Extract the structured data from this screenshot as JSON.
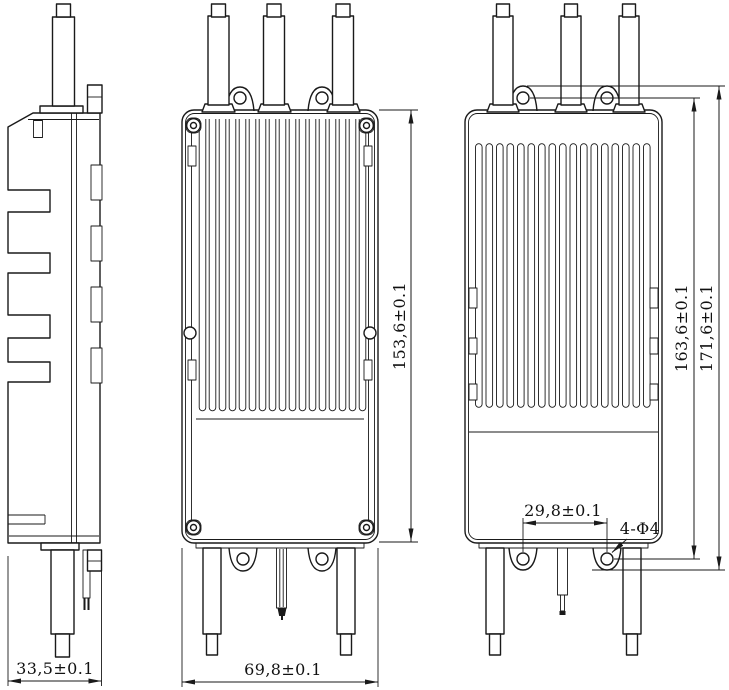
{
  "drawing": {
    "type": "engineering-drawing-three-views",
    "colors": {
      "line": "#1a1a1a",
      "background": "#ffffff"
    },
    "dimensions": {
      "side_width": "33,5±0.1",
      "front_width": "69,8±0.1",
      "body_length": "153,6±0.1",
      "hole_span_length": "163,6±0.1",
      "overall_length": "171,6±0.1",
      "bottom_hole_span": "29,8±0.1",
      "hole_callout": "4-Φ4"
    }
  }
}
